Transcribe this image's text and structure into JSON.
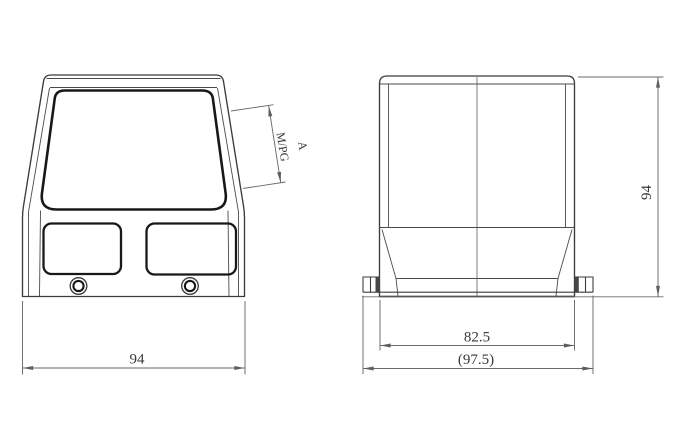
{
  "drawing": {
    "type": "technical-orthographic-drawing",
    "subject": "connector-hood-two-views",
    "background_color": "#ffffff",
    "outline_color": "#3c3c3c",
    "bold_outline_color": "#181818",
    "dimension_color": "#6a6a6a",
    "front_view": {
      "width_dim_label": "94",
      "cable_entry_thread_label": "M/PG",
      "cable_entry_size_label": "A"
    },
    "side_view": {
      "height_dim_label": "94",
      "base_width_dim_label": "82.5",
      "overall_width_dim_label": "(97.5)"
    }
  }
}
